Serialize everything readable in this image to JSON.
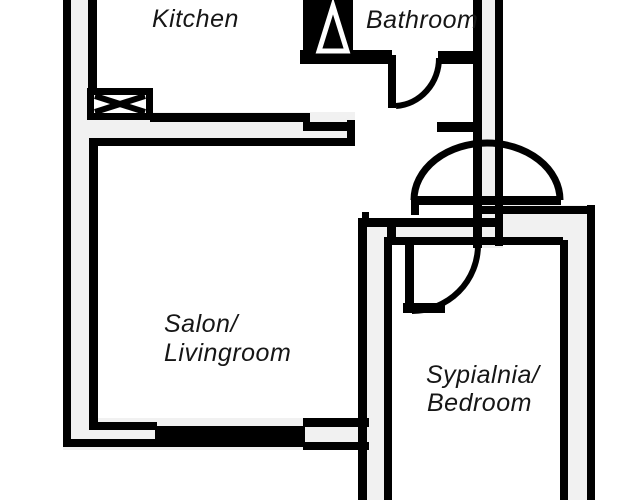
{
  "plan": {
    "type": "apartment-floor-plan",
    "rooms": [
      {
        "id": "kitchen",
        "label": "Kitchen"
      },
      {
        "id": "bathroom",
        "label": "Bathroom"
      },
      {
        "id": "living",
        "label_line1": "Salon/",
        "label_line2": "Livingroom"
      },
      {
        "id": "bedroom",
        "label_line1": "Sypialnia/",
        "label_line2": "Bedroom"
      }
    ],
    "symbols": {
      "shaft": "crossed-box-shaft-symbol",
      "shower": "shower-triangle-symbol",
      "window": "solid-window-band",
      "doors": [
        "bathroom-door-arc",
        "entrance-door-arc",
        "bedroom-door-arc"
      ]
    },
    "colors": {
      "background": "#ffffff",
      "wall_fill": "#f1f1f1",
      "line": "#000000",
      "label": "#161616"
    }
  }
}
